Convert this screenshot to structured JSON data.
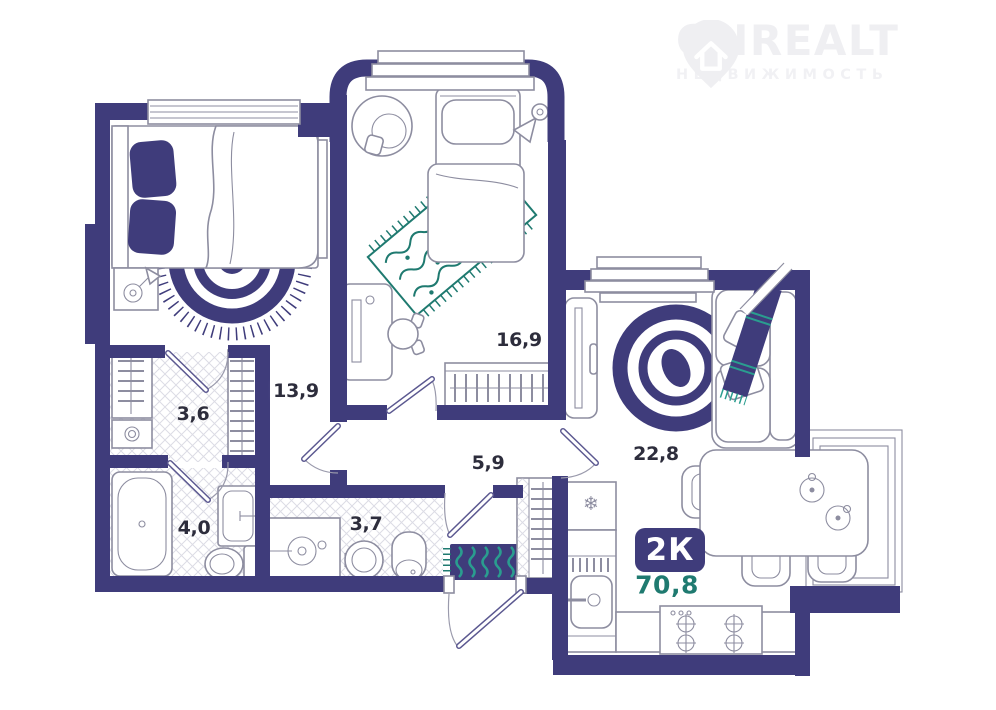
{
  "brand": {
    "name": "ONREALT",
    "tagline": "НЕДВИЖИМОСТЬ"
  },
  "unit": {
    "type_label": "2К",
    "total_area": "70,8"
  },
  "rooms": {
    "bedroom1": "13,9",
    "bedroom2": "16,9",
    "wardrobe": "3,6",
    "bathroom": "4,0",
    "washroom": "3,7",
    "hallway": "5,9",
    "living_kitchen": "22,8"
  },
  "icons": {
    "fridge_snowflake": "❄"
  },
  "colors": {
    "wall": "#3F3C7B",
    "accent_teal": "#1F7A70",
    "rug_teal": "#2A9D8F",
    "watermark": "#EFEFF2"
  }
}
